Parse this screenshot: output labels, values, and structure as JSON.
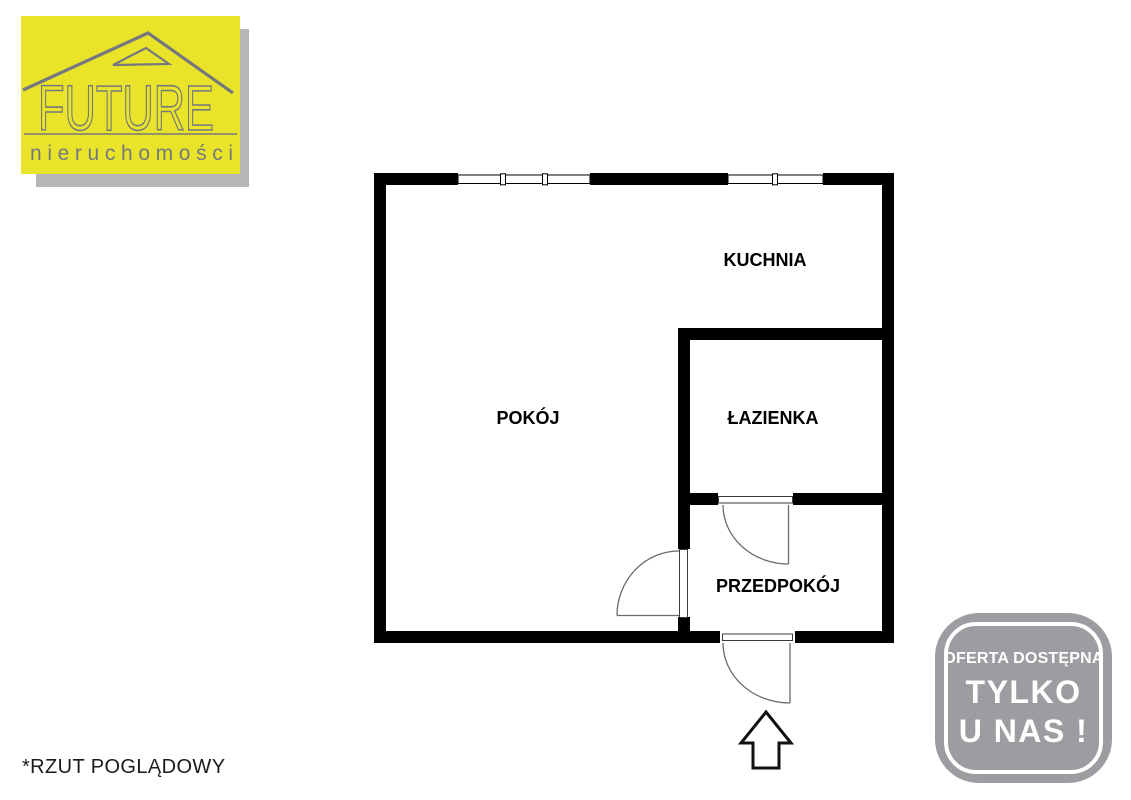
{
  "logo": {
    "brand": "FUTURE",
    "subtitle": "nieruchomości",
    "background_color": "#e9e42a",
    "text_color": "#75787e",
    "shadow_color": "#b5b6b8"
  },
  "floor_plan": {
    "rooms": [
      {
        "name": "KUCHNIA"
      },
      {
        "name": "POKÓJ"
      },
      {
        "name": "ŁAZIENKA"
      },
      {
        "name": "PRZEDPOKÓJ"
      }
    ],
    "wall_color": "#000000",
    "door_line_color": "#6b6b6b",
    "label_color": "#000000"
  },
  "entrance_arrow": {
    "direction": "up"
  },
  "footnote": "*RZUT POGLĄDOWY",
  "badge": {
    "line1": "OFERTA DOSTĘPNA",
    "line2": "TYLKO",
    "line3": "U NAS !",
    "background_color": "#9b9da0",
    "text_color": "#ffffff"
  }
}
